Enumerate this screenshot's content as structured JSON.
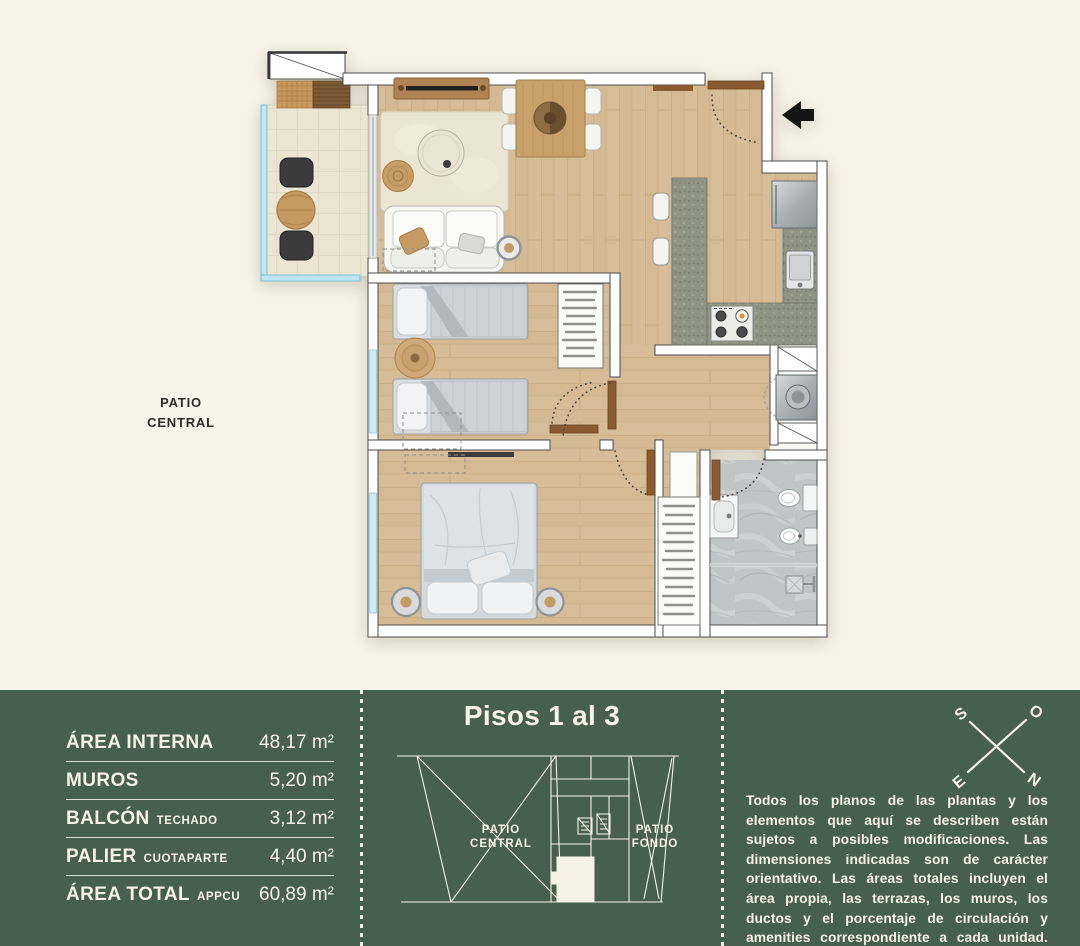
{
  "plan": {
    "patio_label_line1": "PATIO",
    "patio_label_line2": "CENTRAL"
  },
  "areas": {
    "rows": [
      {
        "label": "ÁREA INTERNA",
        "sub": "",
        "value": "48,17 m²"
      },
      {
        "label": "MUROS",
        "sub": "",
        "value": "5,20 m²"
      },
      {
        "label": "BALCÓN",
        "sub": "TECHADO",
        "value": "3,12 m²"
      },
      {
        "label": "PALIER",
        "sub": "CUOTAPARTE",
        "value": "4,40 m²"
      },
      {
        "label": "ÁREA TOTAL",
        "sub": "APPCU",
        "value": "60,89 m²"
      }
    ]
  },
  "keyplan": {
    "title": "Pisos 1 al 3",
    "patio_central_line1": "PATIO",
    "patio_central_line2": "CENTRAL",
    "patio_fondo_line1": "PATIO",
    "patio_fondo_line2": "FONDO"
  },
  "compass": {
    "s": "S",
    "o": "O",
    "e": "E",
    "n": "N"
  },
  "disclaimer": {
    "text": "Todos los planos de las plantas y los elementos que aquí se describen están sujetos a posibles modificaciones. Las dimensiones indicadas son de carácter orientativo. Las áreas totales incluyen el área propia, las terrazas, los muros, los ductos y el porcentaje de circulación y amenities correspondiente a cada unidad."
  },
  "colors": {
    "panel_green": "#46604D",
    "cream_background": "#F8F4E9",
    "wood_floor": "#D6BC96",
    "glass_blue": "#BFE6F2",
    "door_wood": "#8A5A33"
  }
}
